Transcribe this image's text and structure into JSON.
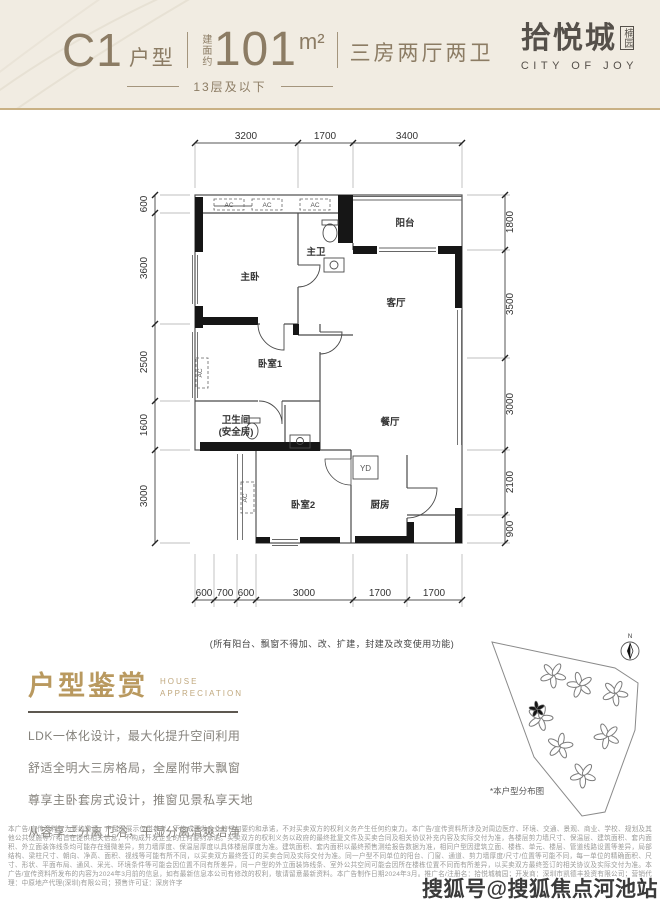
{
  "header": {
    "unit_code": "C1",
    "unit_type_label": "户型",
    "area_prefix": "建面约",
    "area_value": "101",
    "area_unit": "m²",
    "layout_desc": "三房两厅两卫",
    "floor_note": "13层及以下",
    "logo": {
      "name_cn": "拾悦城",
      "name_sub": "楠园",
      "name_en": "CITY OF JOY"
    }
  },
  "plan": {
    "dims": {
      "top": [
        "3200",
        "1700",
        "3400"
      ],
      "left": [
        "600",
        "3600",
        "2500",
        "1600",
        "3000"
      ],
      "right": [
        "1800",
        "3500",
        "3000",
        "2100",
        "900"
      ],
      "bottom": [
        "600",
        "700",
        "600",
        "3000",
        "1700",
        "1700"
      ]
    },
    "rooms": {
      "master_bedroom": "主卧",
      "master_bath": "主卫",
      "balcony": "阳台",
      "living_room": "客厅",
      "bedroom1": "卧室1",
      "dining_room": "餐厅",
      "bath2_line1": "卫生间",
      "bath2_line2": "(安全房)",
      "bedroom2": "卧室2",
      "kitchen": "厨房",
      "yd": "YD",
      "ac": "AC"
    },
    "note": "(所有阳台、飘窗不得加、改、扩建，封建及改变使用功能)"
  },
  "appreciation": {
    "title": "户型鉴赏",
    "subtitle_line1": "HOUSE",
    "subtitle_line2": "APPRECIATION",
    "features": [
      "LDK一体化设计，最大化提升空间利用",
      "舒适全明大三房格局，全屋附带大飘窗",
      "尊享主卧套房式设计，推窗见景私享天地",
      "从容享三分离卫浴，干湿分离清爽洁净"
    ]
  },
  "siteplan": {
    "compass_label": "N",
    "caption": "*本户型分布图"
  },
  "disclaimer": "本广告/宣传资料仅为要约邀请，户型图展示仅供参考，不构成开发企业的任何要约和承诺，不对买卖双方的权利义务产生任何约束力。本广告/宣传资料所涉及对周边医疗、环境、交通、景观、商业、学校、规划及其他公共设施等介绍旨在提供相关信息，不构成开发企业的任何要约承诺。买卖双方的权利义务以政府的最终批复文件及买卖合同及相关协议补充内容及实际交付为准，各楼层剪力墙尺寸、保温层、建筑面积、套内面积、外立面装饰线条均可能存在细微差异，剪力墙厚度、保温层厚度以具体楼层厚度为准。建筑面积、套内面积以最终预售测绘报告数据为准，相同户型因建筑立面、楼栋、单元、楼层、管道线路设置等差异，局部结构、梁柱尺寸、朝向、净高、面积、视线等可能有所不同，以买卖双方最终签订的买卖合同及实际交付为准。同一户型不同单位的阳台、门窗、通道、剪力墙厚度/尺寸/位置等可能不同，每一单位的精确面积、尺寸、形状、平面布局、通风、采光、环境条件等可能会因位置不同有所差异，同一户型的外立面装饰线条、室外公共空间可能会因所在楼栋位置不同而有所差异，以买卖双方最终签订的相关协议及实际交付为准。本广告/宣传资料所发布的内容为2024年3月前的信息，如有最新信息本公司有修改的权利，敬请留意最新资料。本广告制作日期2024年3月。推广名/注册名：拾悦城楠园；开发商：深圳市凯德丰投资有限公司；营销代理：中原地产代理(深圳)有限公司；预售许可证：深房许字",
  "watermark": "搜狐号@搜狐焦点河池站",
  "colors": {
    "header_bg": "#f1ece2",
    "header_text": "#8c7c64",
    "gold_line": "#c9b185",
    "logo_text": "#55504a",
    "appreciation_title": "#b9995f",
    "wall": "#161616"
  }
}
